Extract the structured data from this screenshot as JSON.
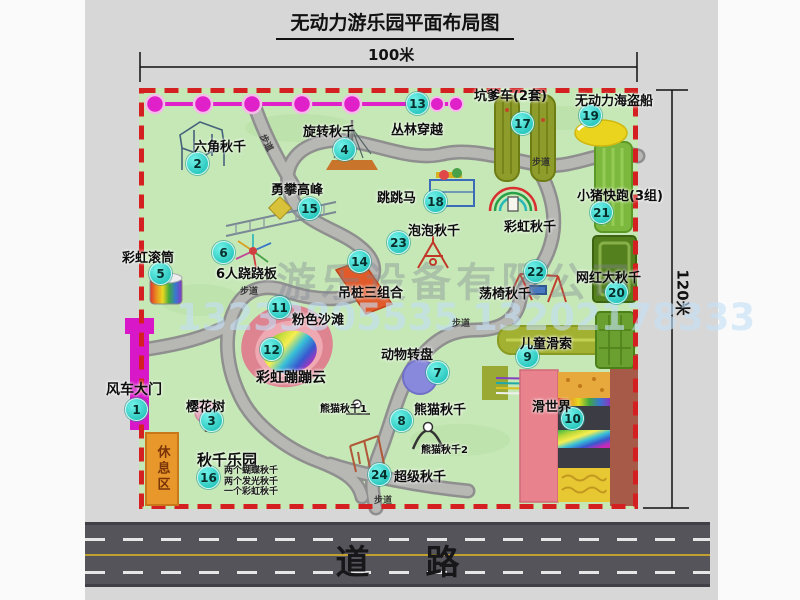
{
  "title": "无动力游乐园平面布局图",
  "dimensions": {
    "width": "100米",
    "height": "120米"
  },
  "road": {
    "label": "道路"
  },
  "watermark": {
    "company": "游乐设备有限公司",
    "phone": "13233805535 13202178333"
  },
  "rest_area": "休息区",
  "path_label": "步道",
  "extra_labels": {
    "rainbow_swing": "彩虹秋千",
    "panda_swing_1": "熊猫秋千1",
    "panda_swing_2": "熊猫秋千2"
  },
  "swing_park_notes": [
    "两个蝴蝶秋千",
    "两个发光秋千",
    "一个彩虹秋千"
  ],
  "attractions": [
    {
      "num": "1",
      "name": "风车大门"
    },
    {
      "num": "2",
      "name": "六角秋千"
    },
    {
      "num": "3",
      "name": "樱花树"
    },
    {
      "num": "4",
      "name": "旋转秋千"
    },
    {
      "num": "5",
      "name": "彩虹滚筒"
    },
    {
      "num": "6",
      "name": "6人跷跷板"
    },
    {
      "num": "7",
      "name": "动物转盘"
    },
    {
      "num": "8",
      "name": "熊猫秋千"
    },
    {
      "num": "9",
      "name": "儿童滑索"
    },
    {
      "num": "10",
      "name": "滑世界"
    },
    {
      "num": "11",
      "name": "粉色沙滩"
    },
    {
      "num": "12",
      "name": "彩虹蹦蹦云"
    },
    {
      "num": "13",
      "name": "丛林穿越"
    },
    {
      "num": "14",
      "name": "吊桩三组合"
    },
    {
      "num": "15",
      "name": "勇攀高峰"
    },
    {
      "num": "16",
      "name": "秋千乐园"
    },
    {
      "num": "17",
      "name": "坑爹车(2套)"
    },
    {
      "num": "18",
      "name": "跳跳马"
    },
    {
      "num": "19",
      "name": "无动力海盗船"
    },
    {
      "num": "20",
      "name": "网红大秋千"
    },
    {
      "num": "21",
      "name": "小猪快跑(3组)"
    },
    {
      "num": "22",
      "name": "荡椅秋千"
    },
    {
      "num": "23",
      "name": "泡泡秋千"
    },
    {
      "num": "24",
      "name": "超级秋千"
    }
  ],
  "colors": {
    "badge": "#2cc9c0",
    "chain": "#e020c8",
    "border": "#d42020",
    "map_green": "#c6e8b6",
    "road": "#54545a"
  }
}
